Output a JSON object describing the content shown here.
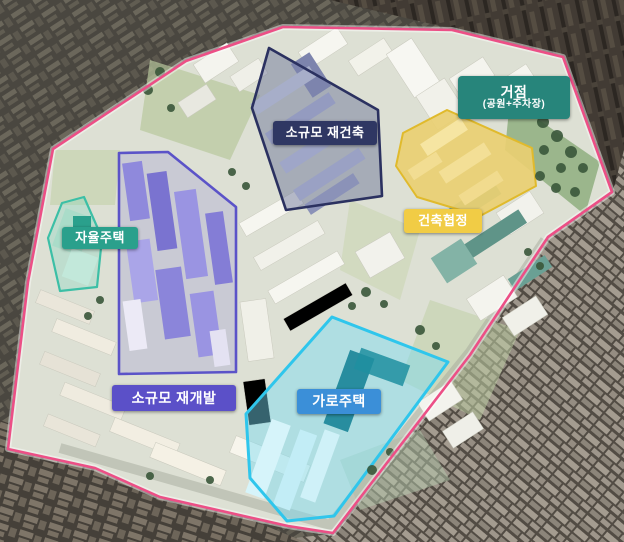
{
  "site": {
    "boundary_color": "#ec4f86"
  },
  "zones": [
    {
      "id": "small-scale-reconstruction",
      "label": "소규모 재건축",
      "label_bg": "#2f3763",
      "outline_color": "#2b3160"
    },
    {
      "id": "small-scale-redevelopment",
      "label": "소규모 재개발",
      "label_bg": "#5b50c8",
      "outline_color": "#5b53c8"
    },
    {
      "id": "autonomous-housing",
      "label": "자율주택",
      "label_bg": "#2aa08c",
      "outline_color": "#3cbfa6"
    },
    {
      "id": "street-housing",
      "label": "가로주택",
      "label_bg": "#3b8fd8",
      "outline_color": "#2fc6ec"
    },
    {
      "id": "building-agreement",
      "label": "건축협정",
      "label_bg": "#f1cc45",
      "outline_color": "#e0ba2c"
    },
    {
      "id": "hub",
      "label": "거점",
      "sublabel": "(공원+주차장)",
      "label_bg": "#27857b"
    }
  ]
}
